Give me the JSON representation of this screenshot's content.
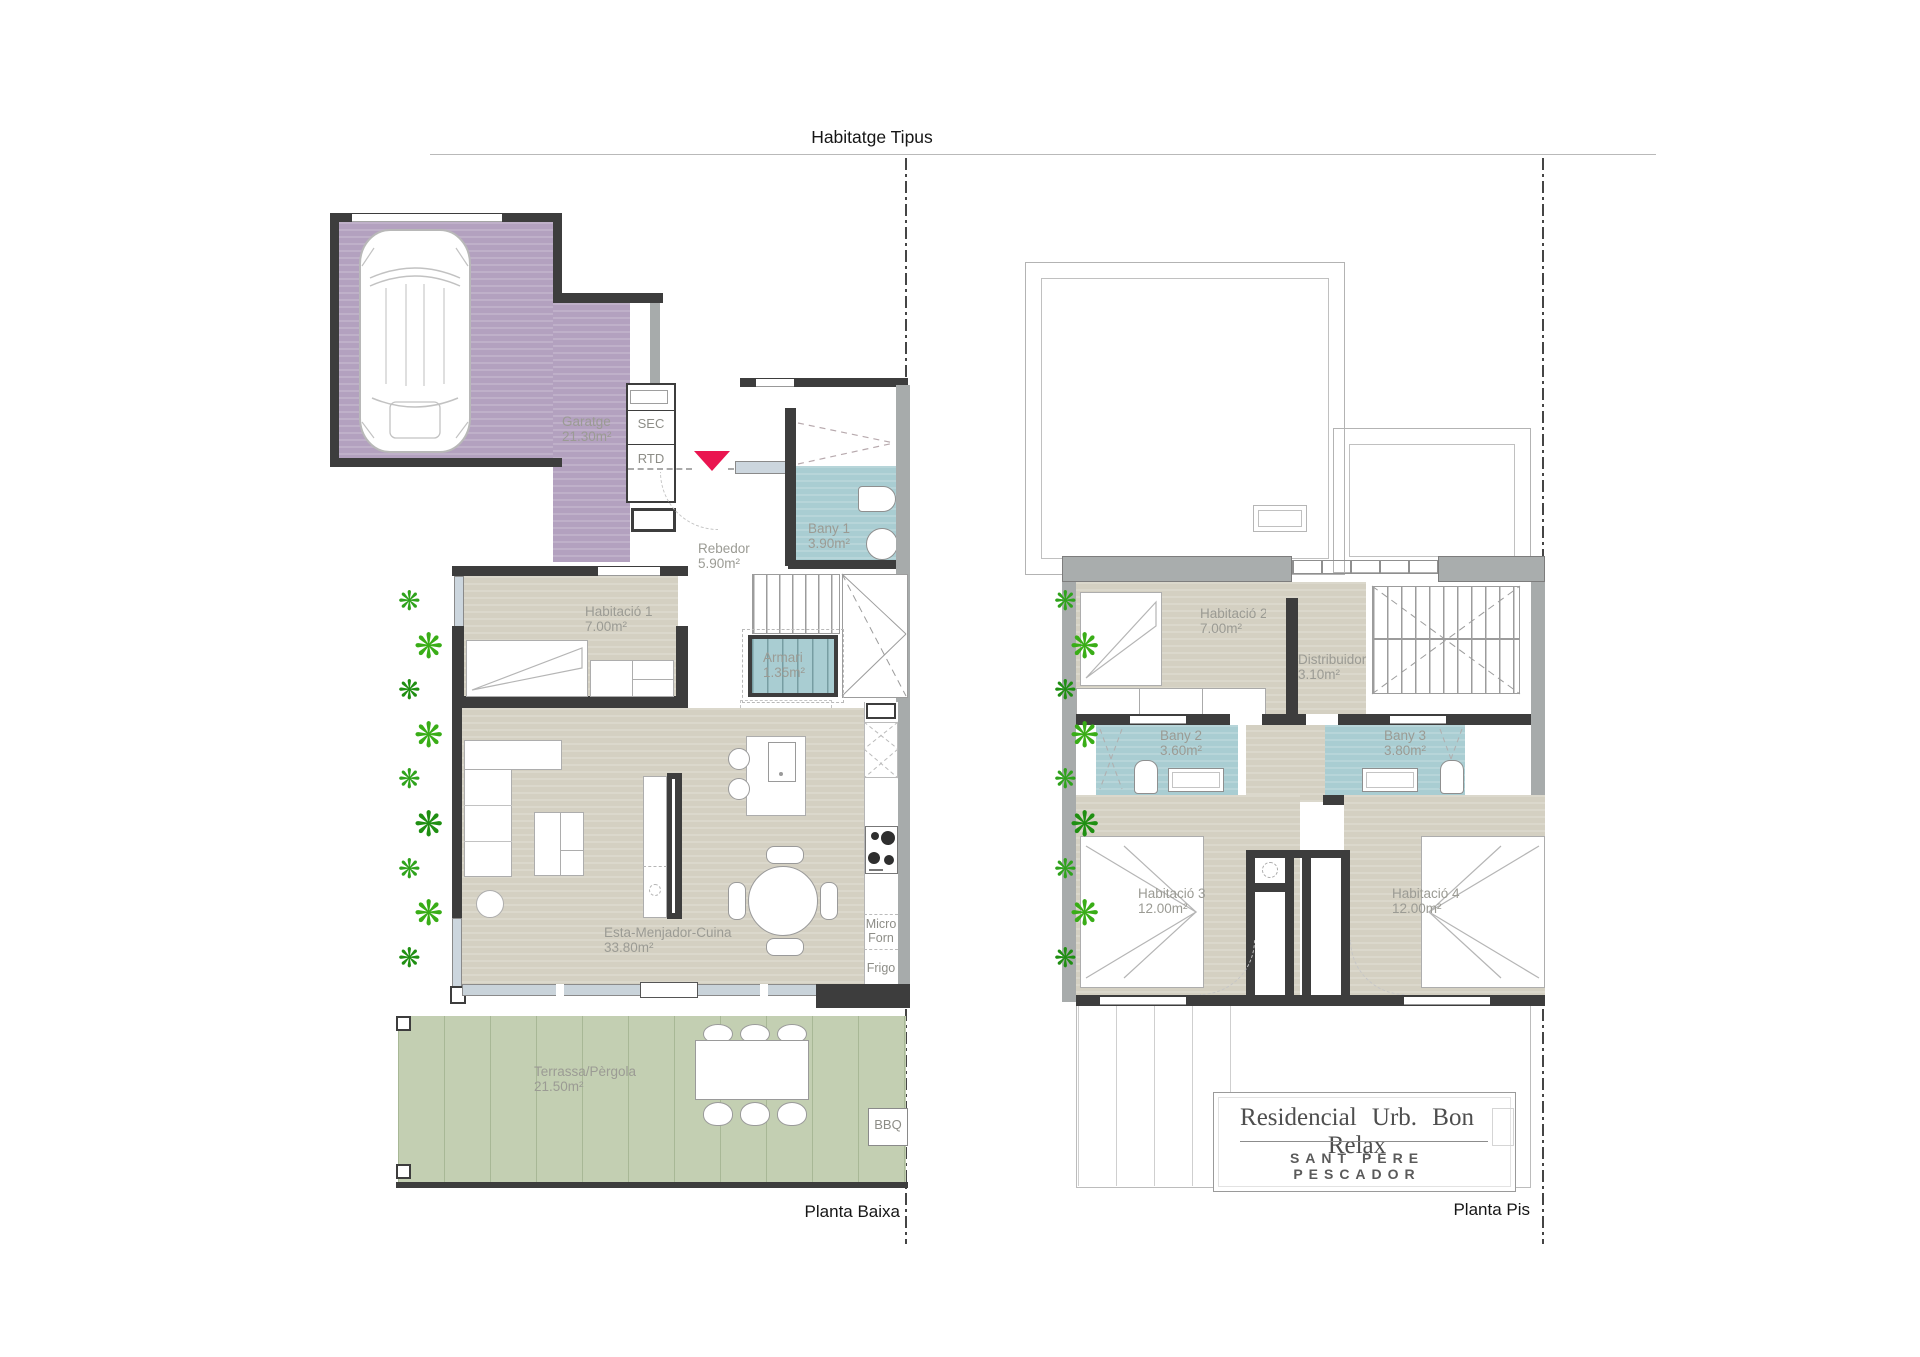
{
  "header": {
    "title": "Habitatge Tipus"
  },
  "icons": {
    "plant": "❋"
  },
  "ground": {
    "caption": "Planta Baixa",
    "garage": {
      "name": "Garatge",
      "area": "21.30m²"
    },
    "sec": "SEC",
    "rtd": "RTD",
    "hall": {
      "name": "Rebedor",
      "area": "5.90m²"
    },
    "bath1": {
      "name": "Bany 1",
      "area": "3.90m²"
    },
    "bedroom1": {
      "name": "Habitació 1",
      "area": "7.00m²"
    },
    "closet": {
      "name": "Armari",
      "area": "1.35m²"
    },
    "rtp": "RTP",
    "living": {
      "name": "Esta-Menjador-Cuina",
      "area": "33.80m²"
    },
    "micro": "Micro",
    "oven": "Forn",
    "fridge": "Frigo",
    "terrace": {
      "name": "Terrassa/Pèrgola",
      "area": "21.50m²"
    },
    "bbq": "BBQ"
  },
  "upper": {
    "caption": "Planta Pis",
    "bedroom2": {
      "name": "Habitació 2",
      "area": "7.00m²"
    },
    "distributor": {
      "name": "Distribuidor",
      "area": "3.10m²"
    },
    "bath2": {
      "name": "Bany 2",
      "area": "3.60m²"
    },
    "bath3": {
      "name": "Bany 3",
      "area": "3.80m²"
    },
    "bedroom3": {
      "name": "Habitació 3",
      "area": "12.00m²"
    },
    "bedroom4": {
      "name": "Habitació 4",
      "area": "12.00m²"
    },
    "titleblock": {
      "line1": "Residencial  Urb.  Bon Relax",
      "line2": "SANT PERE PESCADOR"
    }
  },
  "colors": {
    "garage_floor": "#b3a1bf",
    "bath_floor": "#a9cdd2",
    "room_floor": "#d4d0c2",
    "terrace_floor": "#c3cfb2",
    "wall_dark": "#3d3d3d",
    "wall_gray": "#a7abab",
    "plant_green": "#2fa31c",
    "entry_marker": "#ea1550"
  }
}
